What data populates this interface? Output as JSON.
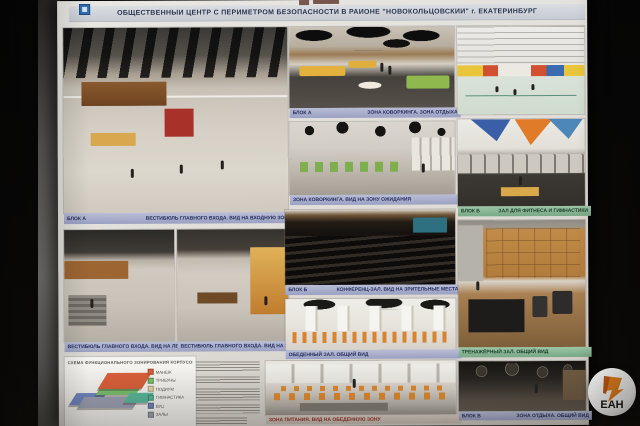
{
  "photo": {
    "watermark": "ЕАН"
  },
  "poster": {
    "title": "ОБЩЕСТВЕННЫЙ ЦЕНТР С ПЕРИМЕТРОМ БЕЗОПАСНОСТИ В РАЙОНЕ \"НОВОКОЛЬЦОВСКИЙ\" г. ЕКАТЕРИНБУРГ",
    "captions": {
      "lobby_main_block": "БЛОК А",
      "lobby_main": "ВЕСТИБЮЛЬ ГЛАВНОГО ВХОДА. ВИД НА ВХОДНУЮ ЗОНУ",
      "lobby_stairs": "ВЕСТИБЮЛЬ ГЛАВНОГО ВХОДА. ВИД НА ЛЕСТНИЦУ",
      "lobby_reception": "ВЕСТИБЮЛЬ ГЛАВНОГО ВХОДА. ВИД НА ЗОНУ РЕСЕПШН",
      "coworking_block": "БЛОК А",
      "coworking": "ЗОНА КОВОРКИНГА. ЗОНА ОТДЫХА",
      "lounge": "ЗОНА КОВОРКИНГА. ВИД НА ЗОНУ ОЖИДАНИЯ",
      "auditorium_block": "БЛОК Б",
      "auditorium": "КОНФЕРЕНЦ-ЗАЛ. ВИД НА ЗРИТЕЛЬНЫЕ МЕСТА",
      "dining": "ОБЕДЕННЫЙ ЗАЛ. ОБЩИЙ ВИД",
      "cafeteria": "ЗОНА ПИТАНИЯ. ВИД НА ОБЕДЕННУЮ ЗОНУ",
      "fitness_block": "БЛОК Б",
      "fitness": "ЗАЛ ДЛЯ ФИТНЕСА И ГИМНАСТИКИ",
      "gym": "ТРЕНАЖЁРНЫЙ ЗАЛ. ОБЩИЙ ВИД",
      "dark_hall_block": "БЛОК В",
      "dark_hall": "ЗОНА ОТДЫХА. ОБЩИЙ ВИД"
    },
    "scheme": {
      "title": "СХЕМА ФУНКЦИОНАЛЬНОГО ЗОНИРОВАНИЯ КОРПУСОВ ЗДАНИЯ",
      "legend": [
        {
          "label": "МАНЕЖ",
          "color": "#d95f3b"
        },
        {
          "label": "ТРИБУНЫ",
          "color": "#7abf6e"
        },
        {
          "label": "ПОДИУМ",
          "color": "#e3d6a6"
        },
        {
          "label": "ГИМНАСТИКА",
          "color": "#58b89c"
        },
        {
          "label": "ВУЦ",
          "color": "#6f86c0"
        },
        {
          "label": "ЗАЛЫ",
          "color": "#9aa0b2"
        }
      ]
    }
  }
}
